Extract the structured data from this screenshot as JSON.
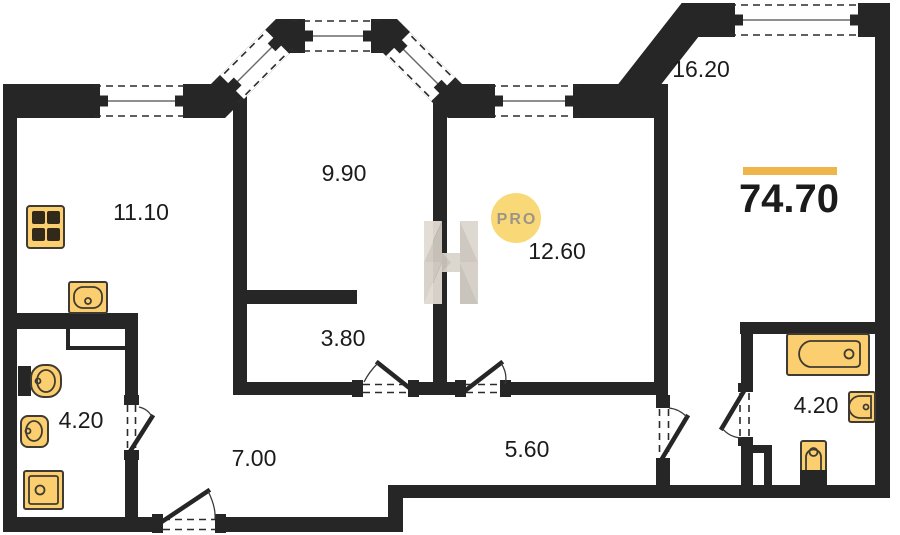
{
  "plan": {
    "total_area": "74.70",
    "watermark_text": "PRO",
    "rooms": [
      {
        "name": "kitchen",
        "area": "11.10"
      },
      {
        "name": "living-room",
        "area": "9.90"
      },
      {
        "name": "bedroom",
        "area": "12.60"
      },
      {
        "name": "room-right",
        "area": "16.20"
      },
      {
        "name": "wardrobe",
        "area": "3.80"
      },
      {
        "name": "hallway",
        "area": "7.00"
      },
      {
        "name": "corridor",
        "area": "5.60"
      },
      {
        "name": "bathroom-left",
        "area": "4.20"
      },
      {
        "name": "bathroom-right",
        "area": "4.20"
      }
    ],
    "colors": {
      "wall": "#262626",
      "fixture_fill": "#FBCF6F",
      "accent_bar": "#EEB54B",
      "pro_badge": "#F9D878"
    }
  }
}
